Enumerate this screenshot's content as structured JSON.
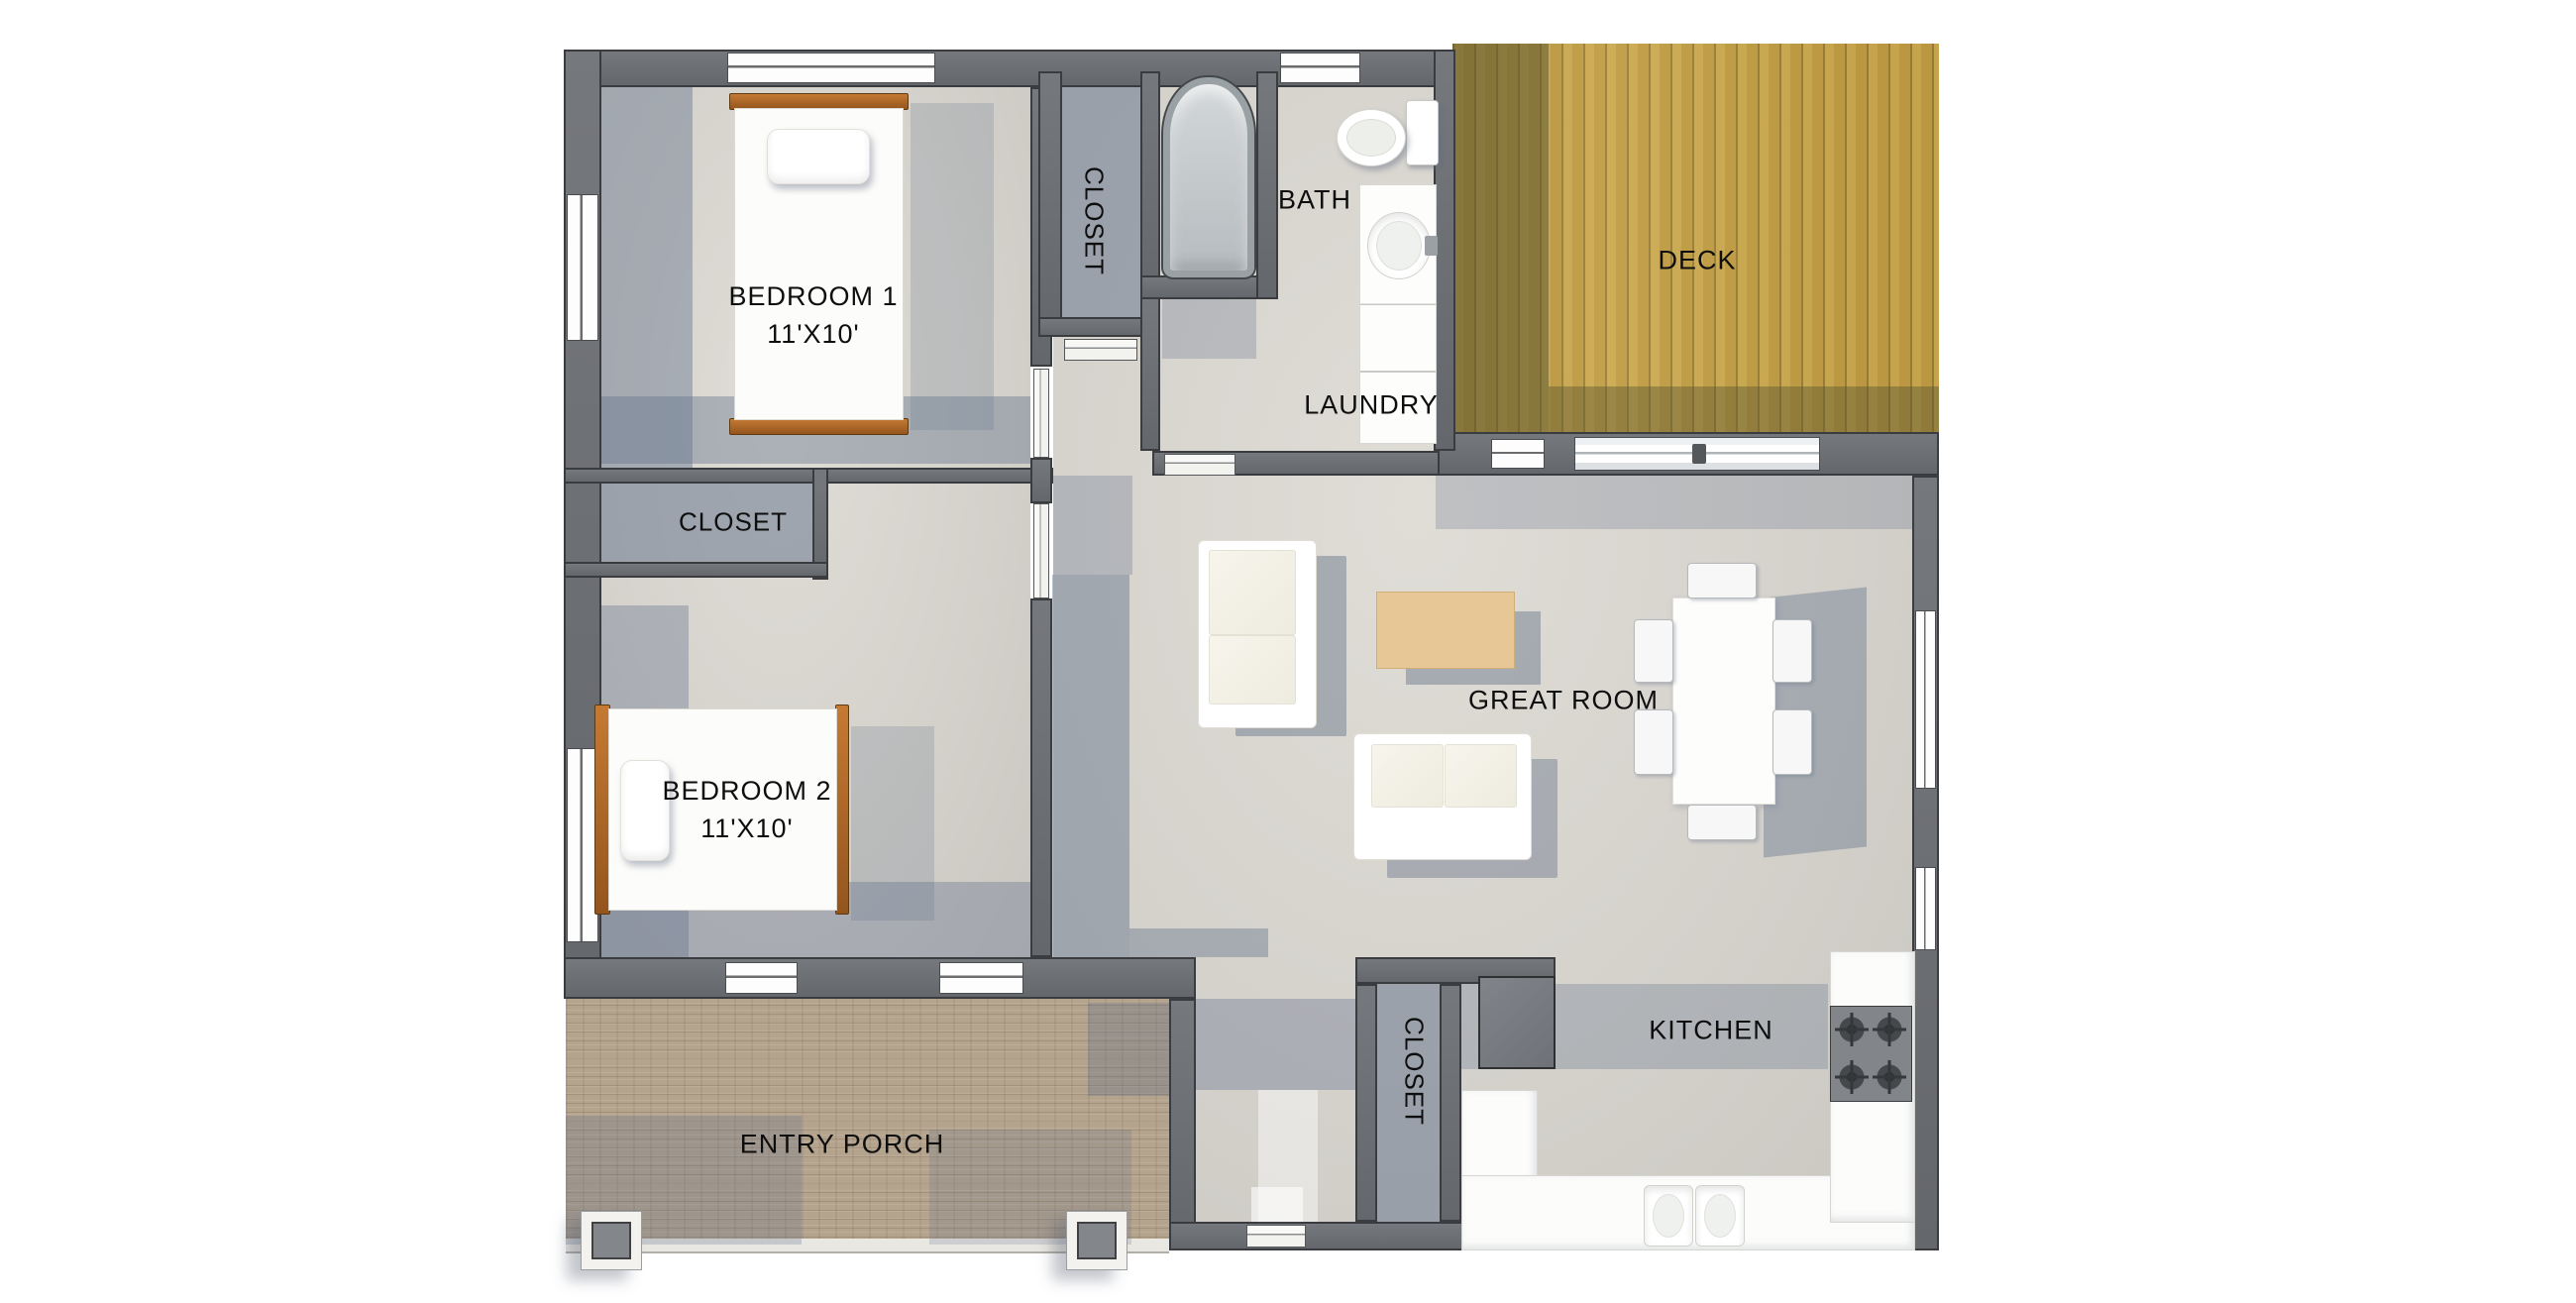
{
  "plan": {
    "title": "single-story house floor plan",
    "rooms": {
      "bedroom1": {
        "label": "BEDROOM 1",
        "size": "11'X10'"
      },
      "bedroom2": {
        "label": "BEDROOM 2",
        "size": "11'X10'"
      },
      "closet_top": {
        "label": "CLOSET"
      },
      "closet_left": {
        "label": "CLOSET"
      },
      "closet_bottom": {
        "label": "CLOSET"
      },
      "bath": {
        "label": "BATH"
      },
      "laundry": {
        "label": "LAUNDRY"
      },
      "deck": {
        "label": "DECK"
      },
      "great_room": {
        "label": "GREAT ROOM"
      },
      "kitchen": {
        "label": "KITCHEN"
      },
      "entry_porch": {
        "label": "ENTRY PORCH"
      }
    },
    "colors": {
      "wall": "#6b6e73",
      "wall_outline": "#3a3c3f",
      "floor_concrete": "#d5d2cc",
      "floor_shadow": "#8796a8",
      "deck_wood": "#c5a047",
      "porch_brick": "#b4a38d",
      "bed_wood": "#b06a28",
      "coffee_table": "#e6c795",
      "label_text": "#0e0e0e"
    }
  }
}
